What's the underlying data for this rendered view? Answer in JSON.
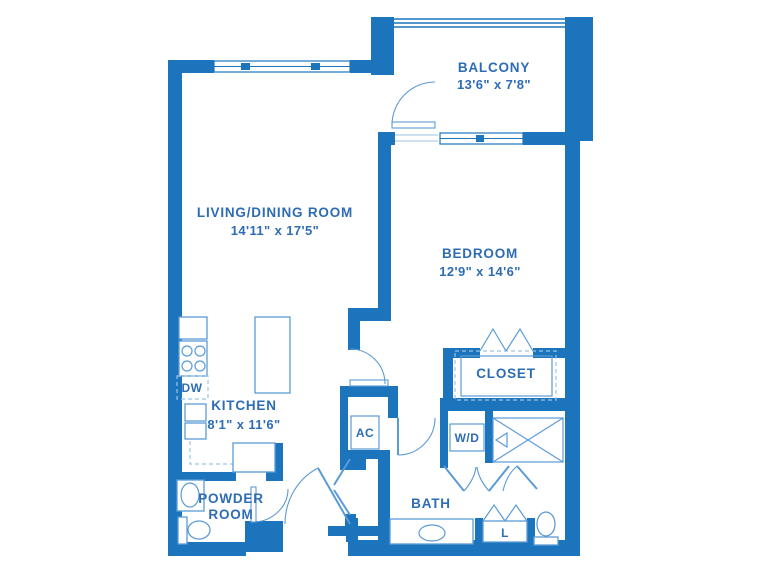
{
  "colors": {
    "wall": "#1C75BC",
    "line": "#5B9BD5",
    "light_line": "#9DC3E6",
    "text": "#2E6DB4",
    "bg": "#FFFFFF"
  },
  "rooms": {
    "balcony": {
      "name": "BALCONY",
      "dims": "13'6\" x 7'8\""
    },
    "living": {
      "name": "LIVING/DINING ROOM",
      "dims": "14'11\" x 17'5\""
    },
    "bedroom": {
      "name": "BEDROOM",
      "dims": "12'9\" x 14'6\""
    },
    "kitchen": {
      "name": "KITCHEN",
      "dims": "8'1\" x 11'6\""
    },
    "closet": {
      "name": "CLOSET"
    },
    "bath": {
      "name": "BATH"
    },
    "powder": {
      "line1": "POWDER",
      "line2": "ROOM"
    }
  },
  "fixtures": {
    "dishwasher": "DW",
    "ac": "AC",
    "washer_dryer": "W/D",
    "linen": "L"
  }
}
